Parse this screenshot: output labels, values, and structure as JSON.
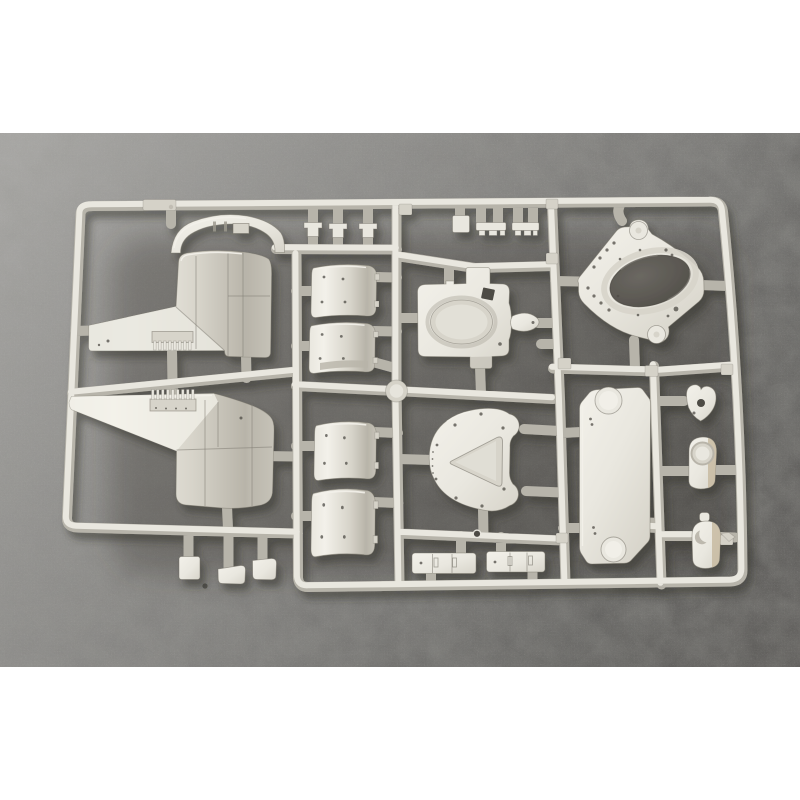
{
  "scene": {
    "type": "product photo",
    "subject": "Injection-molded model kit sprue of light grey styrene with armored-vehicle turret parts, photographed on a dark speckled grey surface, white letterbox bands top and bottom",
    "sprue_material": "light grey polystyrene"
  },
  "colors": {
    "letterbox": "#ffffff",
    "surface-a": "#a9a8a6",
    "surface-b": "#8d8c8a",
    "surface-c": "#757472",
    "surface-d": "#5c5b59",
    "surface-e": "#514f4d",
    "plastic-hi": "#f3f1ea",
    "plastic-light": "#e9e7df",
    "plastic-mid": "#d7d4ca",
    "plastic-dark": "#b8b4a9",
    "plastic-deep": "#9a968b",
    "plastic-tan": "#c6b89e",
    "hole-dark": "#4e4b45",
    "runner-base": "#b7b4aa",
    "runner-mid": "#d5d2c8",
    "runner-hi": "#e9e7df",
    "shadow": "#2f2d2a"
  },
  "sprue": {
    "frame": "rectangular outer runner, slightly tilted, with internal cross runners and square junction pads",
    "parts": [
      {
        "name": "curved-armor-strip",
        "count": 1,
        "where": "top left, arched band above large drum part"
      },
      {
        "name": "gun-house-side-upper",
        "count": 1,
        "where": "left column: curved drum with wedge and toothed rack"
      },
      {
        "name": "gun-house-side-lower",
        "count": 1,
        "where": "left column: mirrored copy below"
      },
      {
        "name": "small-t-clip",
        "count": 3,
        "where": "top centre-left, between frame and cross runner"
      },
      {
        "name": "small-bracket-clip",
        "count": 3,
        "where": "top centre-right, hanging from frame"
      },
      {
        "name": "curved-hull-panel",
        "count": 4,
        "where": "centre-left column, stacked with rivet holes"
      },
      {
        "name": "superstructure-base-oval-recess",
        "count": 1,
        "where": "centre, with dark square hole"
      },
      {
        "name": "small-fairing",
        "count": 1,
        "where": "pointed oval right of superstructure base"
      },
      {
        "name": "turret-roof-plate-oval-opening",
        "count": 1,
        "where": "upper right of centre, two round bosses, many small holes"
      },
      {
        "name": "round-shield-triangular-recess",
        "count": 1,
        "where": "lower centre, two ear bosses"
      },
      {
        "name": "octagonal-hull-plate",
        "count": 1,
        "where": "lower right of centre, round boss top-left and bottom-right"
      },
      {
        "name": "arrowhead-bracket-with-hole",
        "count": 1,
        "where": "right column, top"
      },
      {
        "name": "cup-housing-round-recess",
        "count": 1,
        "where": "right column, middle, tan shading"
      },
      {
        "name": "cup-housing-crescent-mark",
        "count": 1,
        "where": "right column, bottom, tan shading"
      },
      {
        "name": "hinge-bracket",
        "count": 2,
        "where": "bottom centre between runners"
      },
      {
        "name": "small-fitting",
        "count": 3,
        "where": "hanging below lower-left runner"
      },
      {
        "name": "sprue-gate-dot",
        "count": 2,
        "where": "dark round gate marks on runners"
      }
    ]
  }
}
